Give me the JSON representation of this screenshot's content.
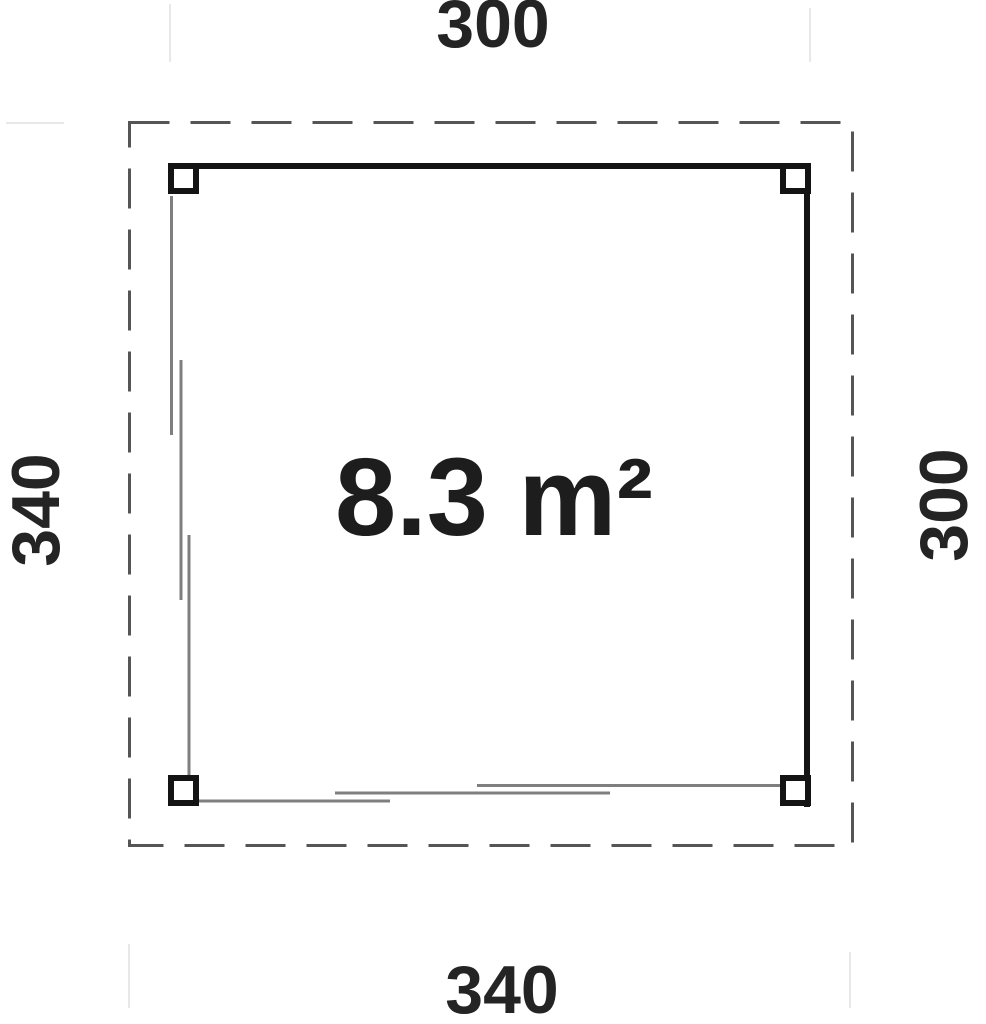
{
  "floor_plan": {
    "area_label": "8.3 m²",
    "dimensions": {
      "top": "300",
      "right": "300",
      "bottom": "340",
      "left": "340"
    },
    "colors": {
      "wall": "#141414",
      "dashed_outline": "#555555",
      "glass_panel": "#7f7f7f",
      "post_fill": "#ffffff",
      "extension_line": "#e8e8e8"
    }
  }
}
